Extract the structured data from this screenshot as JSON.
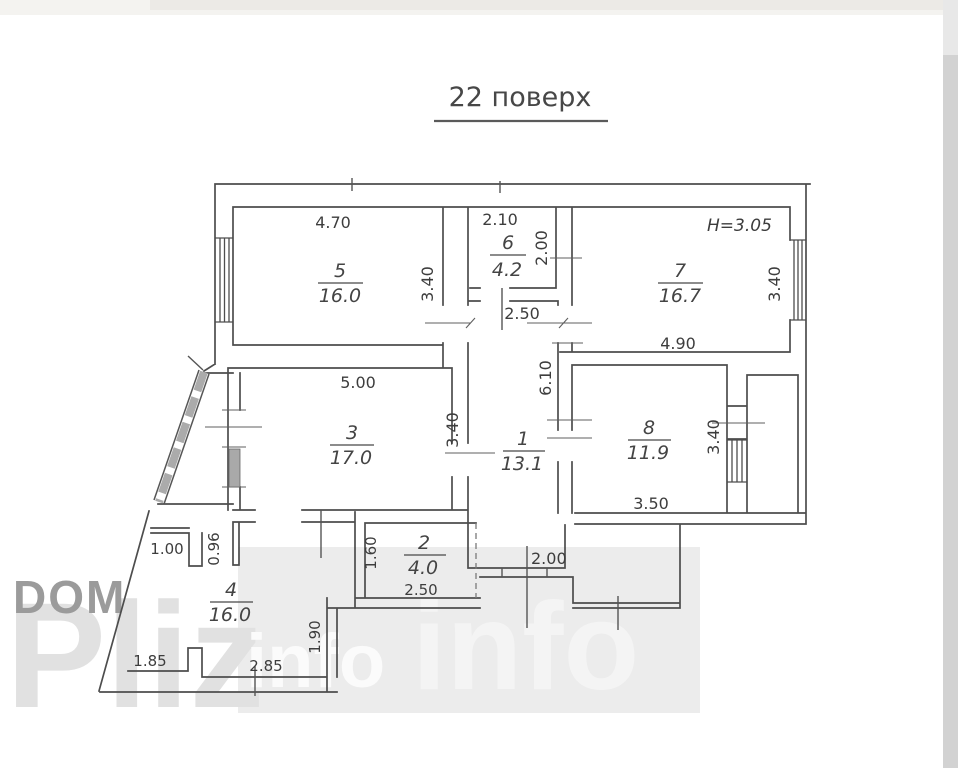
{
  "title": {
    "text": "22 поверх"
  },
  "watermark": {
    "dom": "DOM",
    "pliz": "Pliz",
    "info_small": "info",
    "info_large": "info"
  },
  "rooms": {
    "r1": {
      "number": "1",
      "area": "13.1"
    },
    "r2": {
      "number": "2",
      "area": "4.0"
    },
    "r3": {
      "number": "3",
      "area": "17.0"
    },
    "r4": {
      "number": "4",
      "area": "16.0"
    },
    "r5": {
      "number": "5",
      "area": "16.0"
    },
    "r6": {
      "number": "6",
      "area": "4.2"
    },
    "r7": {
      "number": "7",
      "area": "16.7"
    },
    "r8": {
      "number": "8",
      "area": "11.9"
    }
  },
  "dims": {
    "ceiling": "H=3.05",
    "r5_w": "4.70",
    "r5_d": "3.40",
    "r6_w": "2.10",
    "r6_d": "2.00",
    "r7_w": "4.90",
    "r7_d": "3.40",
    "hall_w": "2.50",
    "hall_d": "6.10",
    "r3_w": "5.00",
    "r3_d": "3.40",
    "r8_w": "3.50",
    "r8_d": "3.40",
    "r2_w": "2.50",
    "r2_d": "1.60",
    "entry_w": "2.00",
    "open_100": "1.00",
    "pier_096": "0.96",
    "bottom_185": "1.85",
    "bottom_285": "2.85",
    "right_190": "1.90"
  },
  "colors": {
    "wall": "#4d4d4d",
    "window_fill": "#a9a9a9",
    "watermark_gray": "#9b9b9b",
    "watermark_light": "#e1e1e1",
    "backdrop": "#ececec"
  }
}
